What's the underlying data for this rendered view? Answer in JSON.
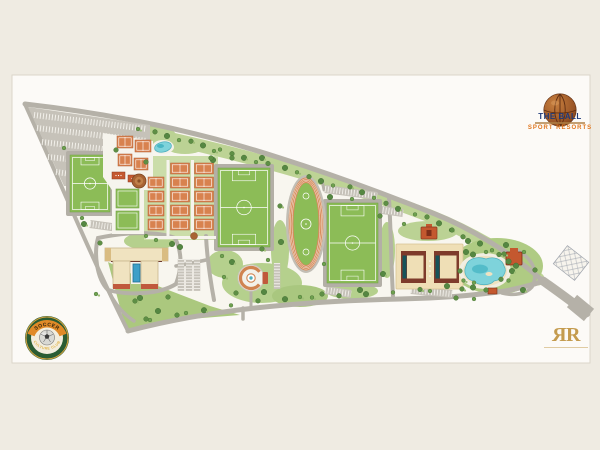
{
  "branding": {
    "title": "THE BALL",
    "subtitle": "SPORT RESORTS"
  },
  "club_badge": {
    "top_text": "SOCCER",
    "bottom_text": "CULTURE CLUB"
  },
  "monogram": {
    "left": "R",
    "right": "R"
  },
  "icons": {
    "basketball-icon": "brown sphere with seams",
    "soccer-ball-icon": "grey ball with pentagon",
    "fine-print-line": "illegible small print rendered as hairline"
  },
  "colors": {
    "background": "#EFEBE2",
    "sheet": "#FCFAF7",
    "field_green": "#8CBC57",
    "clay_court": "#D8824F",
    "track": "#D88B5C",
    "road_gray": "#B5B1A8",
    "water_turquoise": "#7ED3DB",
    "hotel_cream": "#EFDFB6",
    "roof_terracotta": "#C4582F",
    "logo_blue": "#1E3A7A",
    "logo_orange": "#E0761E",
    "badge_green": "#2A5C33",
    "badge_gold": "#D8A33E",
    "monogram_gold": "#C49B4E"
  },
  "plan_features": [
    "parking-lot-northwest",
    "soccer-field-west",
    "practice-courts",
    "tennis-complex-north",
    "leisure-pool-north",
    "tennis-courts-grid",
    "soccer-field-central",
    "athletics-track",
    "soccer-field-east",
    "clubhouse-building",
    "entry-plaza-fountain",
    "hotel-building",
    "lagoon-pool",
    "pool-pavilions",
    "future-development-parcel",
    "access-roads",
    "exit-road-southeast"
  ]
}
